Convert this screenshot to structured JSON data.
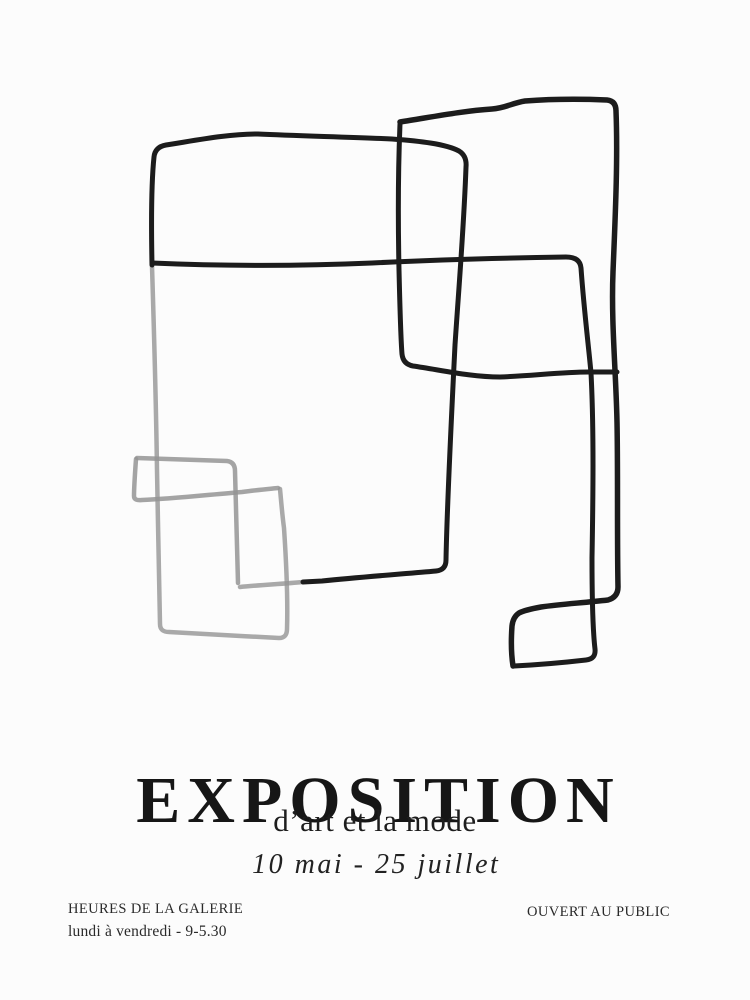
{
  "poster": {
    "title": "EXPOSITION",
    "subtitle": "d’art et la mode",
    "date_range": "10 mai - 25 juillet",
    "footer": {
      "hours_label": "HEURES DE LA GALERIE",
      "hours_value": "lundi à vendredi - 9-5.30",
      "right_note": "OUVERT AU PUBLIC"
    },
    "artwork": {
      "name": "abstract-line-drawing",
      "ink_color": "#1c1c1c",
      "faded_color": "#949494",
      "background_color": "#fcfcfc",
      "text_color": "#1a1a1a"
    }
  }
}
